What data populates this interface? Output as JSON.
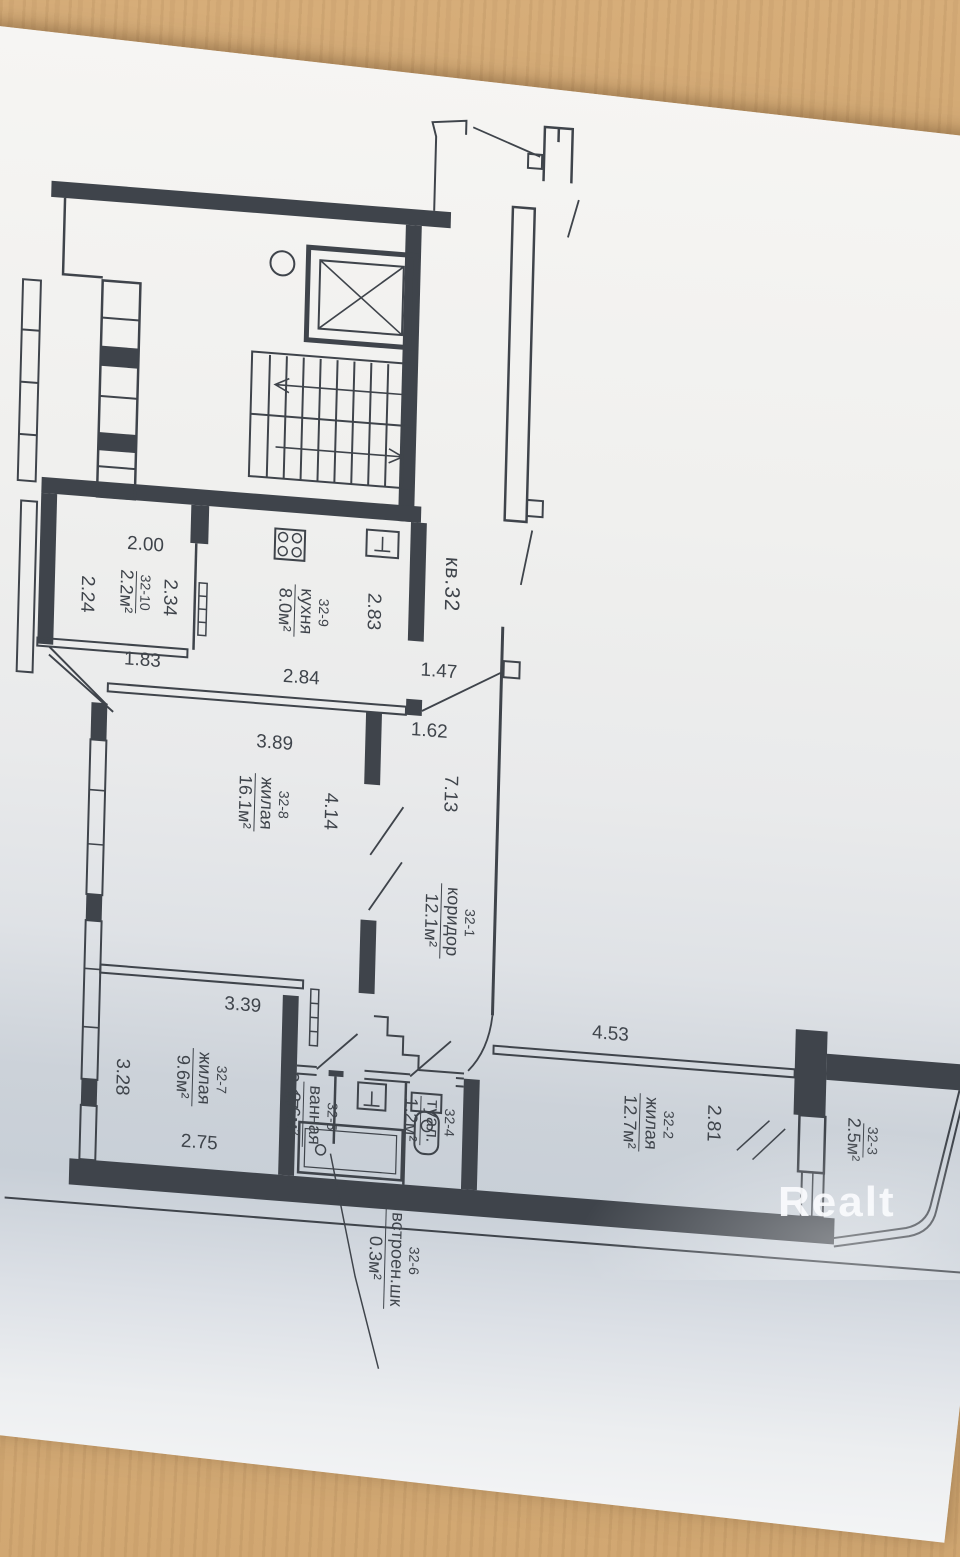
{
  "watermark": {
    "brand": "Realt"
  },
  "plan": {
    "apartment_label": "кв.32",
    "rooms": {
      "r321": {
        "id": "32-1",
        "name": "коридор",
        "area": "12.1м²"
      },
      "r322": {
        "id": "32-2",
        "name": "жилая",
        "area": "12.7м²"
      },
      "r323": {
        "id": "32-3",
        "name": "",
        "area": "2.5м²"
      },
      "r324": {
        "id": "32-4",
        "name": "туал.",
        "area": "1.2м²"
      },
      "r325": {
        "id": "32-5",
        "name": "ванная",
        "area": "2.6м²"
      },
      "r326": {
        "id": "32-6",
        "name": "встроен.шк",
        "area": "0.3м²"
      },
      "r327": {
        "id": "32-7",
        "name": "жилая",
        "area": "9.6м²"
      },
      "r328": {
        "id": "32-8",
        "name": "жилая",
        "area": "16.1м²"
      },
      "r329": {
        "id": "32-9",
        "name": "кухня",
        "area": "8.0м²"
      },
      "r3210": {
        "id": "32-10",
        "name": "",
        "area": "2.2м²"
      }
    },
    "dimensions": {
      "d200": "2.00",
      "d224": "2.24",
      "d234": "2.34",
      "d183": "1.83",
      "d283": "2.83",
      "d284": "2.84",
      "d147": "1.47",
      "d162": "1.62",
      "d389": "3.89",
      "d414": "4.14",
      "d713": "7.13",
      "d339": "3.39",
      "d328": "3.28",
      "d217": "2.17",
      "d275": "2.75",
      "d453": "4.53",
      "d281": "2.81"
    },
    "colors": {
      "ink": "#3f444b",
      "paper": "#f0f0ee",
      "wood": "#cda26b"
    }
  }
}
